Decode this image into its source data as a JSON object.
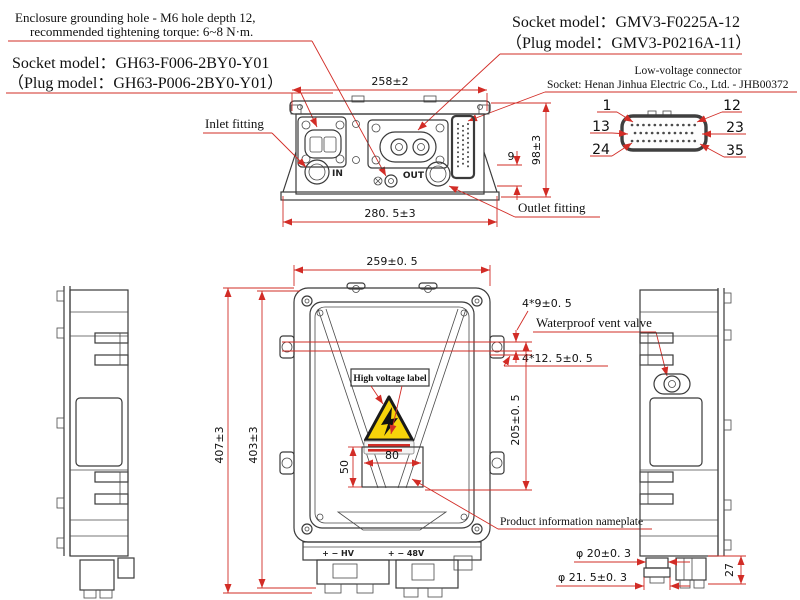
{
  "annotations": {
    "grounding_line1": "Enclosure grounding hole - M6 hole depth 12,",
    "grounding_line2": "recommended tightening torque: 6~8 N·m.",
    "gh63_line1": "Socket model：GH63-F006-2BY0-Y01",
    "gh63_line2": "（Plug model：GH63-P006-2BY0-Y01）",
    "gmv3_line1": "Socket model：GMV3-F0225A-12",
    "gmv3_line2": "（Plug model：GMV3-P0216A-11）",
    "lv_line1": "Low-voltage connector",
    "lv_line2": "Socket: Henan Jinhua Electric Co., Ltd. - JHB00372",
    "inlet": "Inlet fitting",
    "outlet": "Outlet fitting",
    "hv_label": "High voltage label",
    "vent_valve": "Waterproof vent valve",
    "nameplate": "Product information nameplate"
  },
  "dimensions": {
    "top_width": "258±2",
    "top_overall_width": "280. 5±3",
    "top_height": "98±3",
    "top_base": "9",
    "front_width": "259±0. 5",
    "front_height_outer": "407±3",
    "front_height_inner": "403±3",
    "front_right_span": "205±0. 5",
    "hole_pitch_a": "4*9±0. 5",
    "hole_pitch_b": "4*12. 5±0. 5",
    "nameplate_width": "80",
    "nameplate_height": "50",
    "fitting_dia_small": "φ 20±0. 3",
    "fitting_dia_large": "φ 21. 5±0. 3",
    "connector_height": "27"
  },
  "pins": {
    "p1": "1",
    "p12": "12",
    "p13": "13",
    "p23": "23",
    "p24": "24",
    "p35": "35"
  },
  "ports": {
    "inlet": "IN",
    "outlet": "OUT",
    "hv": "+ − HV",
    "lv48": "+ − 48V"
  },
  "colors": {
    "dimension_red": "#d22c26",
    "drawing_line": "#3a3a3a",
    "hazard_yellow": "#f6d30a"
  }
}
